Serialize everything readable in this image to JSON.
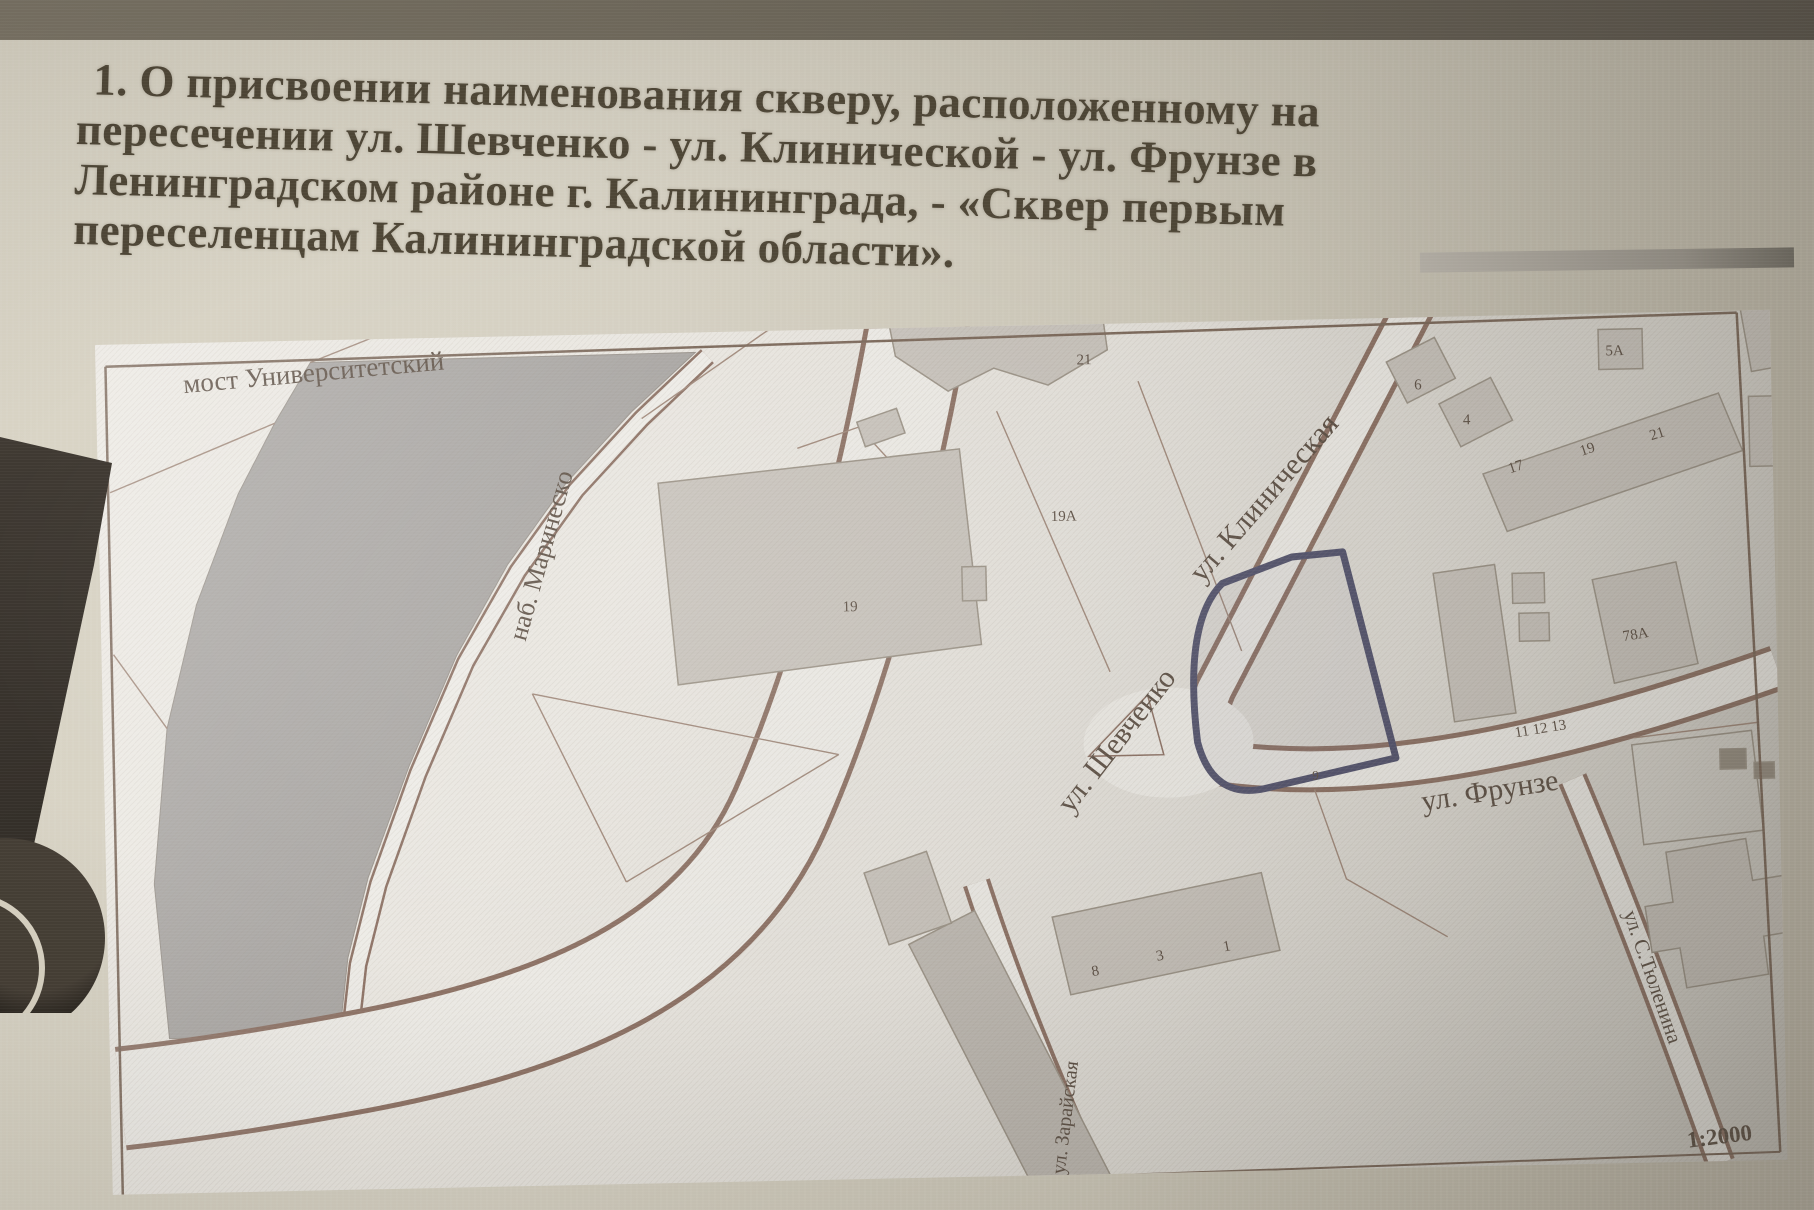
{
  "slide": {
    "title_lines": [
      "1. О присвоении наименования скверу, расположенному на",
      "пересечении ул. Шевченко - ул. Клинической - ул. Фрунзе в",
      "Ленинградском районе г. Калининграда, - «Сквер первым",
      "переселенцам Калининградской области»."
    ]
  },
  "map": {
    "labels": {
      "bridge": "мост Университетский",
      "embankment": "наб. Маринеско",
      "klinicheskaya": "ул. Клиническая",
      "shevchenko": "ул. Шевченко",
      "frunze": "ул. Фрунзе",
      "tyulenina": "ул. С.Тюленина",
      "zarayskaya": "ул. Зарайская",
      "scale": "1:2000"
    },
    "parcel_numbers": {
      "top_building": "21",
      "parcel_19a": "19А",
      "central_building": "19",
      "house_6": "6",
      "house_4": "4",
      "house_17": "17",
      "house_19": "19",
      "house_21": "21",
      "house_5a": "5А",
      "house_78a": "78А",
      "row_houses": "11 12 13",
      "house_8": "8",
      "house_3": "3",
      "house_1": "1",
      "square_parcel": "9"
    },
    "highlight_color": "#54546e"
  }
}
